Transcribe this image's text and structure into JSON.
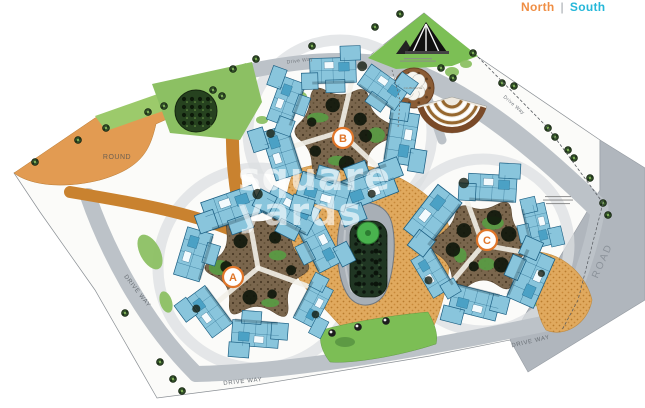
{
  "compass": {
    "north": "North",
    "divider": "|",
    "south": "South"
  },
  "watermark": {
    "line1": "square",
    "line2": "yards"
  },
  "map": {
    "labels": {
      "round": "ROUND",
      "road": "ROAD",
      "drive_way": "DRIVE WAY",
      "drive_way_mixed": "Drive Way",
      "clubhouse": "CLUBHOUSE"
    },
    "clusters": [
      {
        "label": "A"
      },
      {
        "label": "B"
      },
      {
        "label": "C"
      }
    ],
    "colors": {
      "building": "#89c5dc",
      "building_outline": "#1c5f83",
      "road": "#bcc2c8",
      "road_band": "#b0b6bd",
      "plaza": "#e0a95e",
      "courtyard": "#7a664d",
      "green": "#8cc063",
      "orange_area": "#e29b52",
      "marker_accent": "#e0762a",
      "north": "#ef8e44",
      "south": "#24b7d9"
    }
  }
}
